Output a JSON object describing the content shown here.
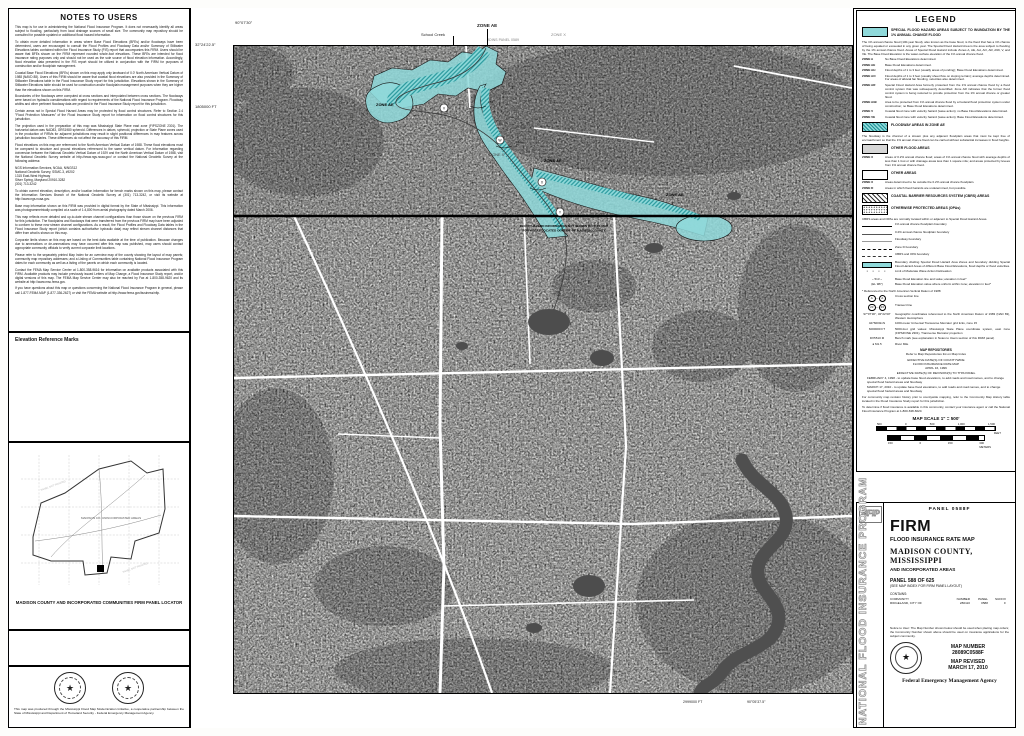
{
  "notes": {
    "title": "NOTES TO USERS",
    "erm_title": "Elevation Reference Marks",
    "paragraphs": [
      "This map is for use in administering the National Flood Insurance Program. It does not necessarily identify all areas subject to flooding, particularly from local drainage sources of small size. The community map repository should be consulted for possible updated or additional flood hazard information.",
      "To obtain more detailed information in areas where Base Flood Elevations (BFEs) and/or floodways have been determined, users are encouraged to consult the Flood Profiles and Floodway Data and/or Summary of Stillwater Elevations tables contained within the Flood Insurance Study (FIS) report that accompanies this FIRM. Users should be aware that BFEs shown on the FIRM represent rounded whole-foot elevations. These BFEs are intended for flood insurance rating purposes only and should not be used as the sole source of flood elevation information. Accordingly, flood elevation data presented in the FIS report should be utilized in conjunction with the FIRM for purposes of construction and/or floodplain management.",
      "Coastal Base Flood Elevations (BFEs) shown on this map apply only landward of 0.0' North American Vertical Datum of 1988 (NAVD 88). Users of this FIRM should be aware that coastal flood elevations are also provided in the Summary of Stillwater Elevations table in the Flood Insurance Study report for this jurisdiction. Elevations shown in the Summary of Stillwater Elevations table should be used for construction and/or floodplain management purposes when they are higher than the elevations shown on this FIRM.",
      "Boundaries of the floodways were computed at cross sections and interpolated between cross sections. The floodways were based on hydraulic considerations with regard to requirements of the National Flood Insurance Program. Floodway widths and other pertinent floodway data are provided in the Flood Insurance Study report for this jurisdiction.",
      "Certain areas not in Special Flood Hazard Areas may be protected by flood control structures. Refer to Section 2.4 \"Flood Protection Measures\" of the Flood Insurance Study report for information on flood control structures for this jurisdiction.",
      "The projection used in the preparation of this map was Mississippi State Plane east zone (FIPSZONE 2301). The horizontal datum was NAD83, GRS1980 spheroid. Differences in datum, spheroid, projection or State Plane zones used in the production of FIRMs for adjacent jurisdictions may result in slight positional differences in map features across jurisdiction boundaries. These differences do not affect the accuracy of this FIRM.",
      "Flood elevations on this map are referenced to the North American Vertical Datum of 1988. These flood elevations must be compared to structure and ground elevations referenced to the same vertical datum. For information regarding conversion between the National Geodetic Vertical Datum of 1929 and the North American Vertical Datum of 1988, visit the National Geodetic Survey website at http://www.ngs.noaa.gov/ or contact the National Geodetic Survey at the following address:",
      "NGS Information Services, NOAA, N/NGS12\nNational Geodetic Survey, SSMC-3, #9202\n1315 East-West Highway\nSilver Spring, Maryland 20910-3282\n(301) 713-3242",
      "To obtain current elevation, description, and/or location information for bench marks shown on this map, please contact the Information Services Branch of the National Geodetic Survey at (301) 713-3242, or visit its website at http://www.ngs.noaa.gov.",
      "Base map information shown on this FIRM was provided in digital format by the State of Mississippi. This information was photogrammetrically compiled at a scale of 1:4,800 from aerial photography dated March 2006.",
      "This map reflects more detailed and up-to-date stream channel configurations than those shown on the previous FIRM for this jurisdiction. The floodplains and floodways that were transferred from the previous FIRM may have been adjusted to conform to these new stream channel configurations. As a result, the Flood Profiles and Floodway Data tables in the Flood Insurance Study report (which contains authoritative hydraulic data) may reflect stream channel distances that differ from what is shown on this map.",
      "Corporate limits shown on this map are based on the best data available at the time of publication. Because changes due to annexations or de-annexations may have occurred after this map was published, map users should contact appropriate community officials to verify current corporate limit locations.",
      "Please refer to the separately printed Map Index for an overview map of the county showing the layout of map panels; community map repository addresses; and a Listing of Communities table containing National Flood Insurance Program dates for each community as well as a listing of the panels on which each community is located.",
      "Contact the FEMA Map Service Center at 1-800-358-9616 for information on available products associated with this FIRM. Available products may include previously issued Letters of Map Change, a Flood Insurance Study report, and/or digital versions of this map. The FEMA Map Service Center may also be reached by Fax at 1-800-358-9620 and its website at http://www.msc.fema.gov.",
      "If you have questions about this map or questions concerning the National Flood Insurance Program in general, please call 1-877-FEMA MAP (1-877-336-2627) or visit the FEMA website at http://www.fema.gov/business/nfip."
    ]
  },
  "locator": {
    "label": "MADISON COUNTY AND INCORPORATED COMMUNITIES FIRM PANEL LOCATOR",
    "panel_not_printed": "PANEL NOT PRINTED",
    "inner_label": "MADISON CO. UNINCORPORATED AREAS",
    "credit": "This map was produced through the Mississippi Flood Map Modernization Initiative, a cooperative partnership between the State of Mississippi and Department of Homeland Security - Federal Emergency Management Agency."
  },
  "map": {
    "collar": {
      "top_left_lon": "90°07'30\"",
      "top_left_lat": "32°24'22.5\"",
      "bottom_grid": "2999000 FT",
      "bottom_lon": "90°05'37.5\"",
      "left_grid": "1805000 FT"
    },
    "joins_top": "JOINS PANEL 0589",
    "joins_right": "JOINS PANEL 0590",
    "labels": {
      "school_creek": "School Creek",
      "zone_ae": "ZONE AE",
      "zone_x": "ZONE X",
      "bfe_282": "282",
      "bfe_286": "286",
      "county_note_1": "FLOOD HAZARD INFORMATION NOT SHOWN ON THIS MAP",
      "county_note_2": "FOR AREAS LOCATED OUTSIDE OF MADISON COUNTY",
      "xs_v": "V",
      "xs_w": "W",
      "xs_x": "X",
      "xs_y": "Y"
    },
    "annotations": {
      "pct_note_1": "0.2% FLOODING EFFECTS FROM",
      "pct_note_2": "BRASHEAR CREEK",
      "grid_1803": "1803000 FT",
      "zone_x": "ZONE X",
      "flooding_note_1": "FLOODING EFFECTS FROM",
      "flooding_note_2": "BRASHEAR CREEK"
    }
  },
  "legend": {
    "title": "LEGEND",
    "sfha_header": "SPECIAL FLOOD HAZARD AREAS SUBJECT TO INUNDATION BY THE 1% ANNUAL CHANCE FLOOD",
    "sfha_intro": "The 1% annual chance flood (100-year flood), also known as the base flood, is the flood that has a 1% chance of being equaled or exceeded in any given year. The Special Flood Hazard Area is the area subject to flooding by the 1% annual chance flood. Areas of Special Flood Hazard include Zones A, AE, AH, AO, AR, A99, V, and VE. The Base Flood Elevation is the water-surface elevation of the 1% annual chance flood.",
    "sfha_zones": [
      {
        "name": "ZONE A",
        "desc": "No Base Flood Elevations determined."
      },
      {
        "name": "ZONE AE",
        "desc": "Base Flood Elevations determined."
      },
      {
        "name": "ZONE AH",
        "desc": "Flood depths of 1 to 3 feet (usually areas of ponding); Base Flood Elevations determined."
      },
      {
        "name": "ZONE AO",
        "desc": "Flood depths of 1 to 3 feet (usually sheet flow on sloping terrain); average depths determined. For areas of alluvial fan flooding, velocities also determined."
      },
      {
        "name": "ZONE AR",
        "desc": "Special Flood Hazard Area formerly protected from the 1% annual chance flood by a flood control system that was subsequently decertified. Zone AR indicates that the former flood control system is being restored to provide protection from the 1% annual chance or greater flood."
      },
      {
        "name": "ZONE A99",
        "desc": "Area to be protected from 1% annual chance flood by a Federal flood protection system under construction; no Base Flood Elevations determined."
      },
      {
        "name": "ZONE V",
        "desc": "Coastal flood zone with velocity hazard (wave action); no Base Flood Elevations determined."
      },
      {
        "name": "ZONE VE",
        "desc": "Coastal flood zone with velocity hazard (wave action); Base Flood Elevations determined."
      }
    ],
    "floodway_header": "FLOODWAY AREAS IN ZONE AE",
    "floodway_note": "The floodway is the channel of a stream plus any adjacent floodplain areas that must be kept free of encroachment so that the 1% annual chance flood can be carried without substantial increases in flood heights.",
    "other_flood_header": "OTHER FLOOD AREAS",
    "zone_x_shaded": {
      "name": "ZONE X",
      "desc": "Areas of 0.2% annual chance flood; areas of 1% annual chance flood with average depths of less than 1 foot or with drainage areas less than 1 square mile; and areas protected by levees from 1% annual chance flood."
    },
    "other_areas_header": "OTHER AREAS",
    "zone_x": {
      "name": "ZONE X",
      "desc": "Areas determined to be outside the 0.2% annual chance floodplain."
    },
    "zone_d": {
      "name": "ZONE D",
      "desc": "Areas in which flood hazards are undetermined, but possible."
    },
    "cbrs_header": "COASTAL BARRIER RESOURCES SYSTEM (CBRS) AREAS",
    "opa_header": "OTHERWISE PROTECTED AREAS (OPAs)",
    "cbrs_note": "CBRS areas and OPAs are normally located within or adjacent to Special Flood Hazard Areas.",
    "lines": [
      "1% annual chance floodplain boundary",
      "0.2% annual chance floodplain boundary",
      "Floodway boundary",
      "Zone D boundary",
      "CBRS and OPA boundary",
      "Boundary dividing Special Flood Hazard Area Zones and boundary dividing Special Flood Hazard Areas of different Base Flood Elevations, flood depths or flood velocities.",
      "Limit of Moderate Wave Action Delineation"
    ],
    "bfe_line": {
      "symbol": "~ 513 ~",
      "desc": "Base Flood Elevation line and value; elevation in feet*"
    },
    "bfe_zone": {
      "symbol": "(EL 987)",
      "desc": "Base Flood Elevation value where uniform within zone; elevation in feet*"
    },
    "navd_note": "* Referenced to the North American Vertical Datum of 1988",
    "cross_section": {
      "letter": "A",
      "desc": "Cross section line"
    },
    "transect": {
      "number": "23",
      "desc": "Transect line"
    },
    "geo": {
      "symbol": "97°07'30\", 32°22'30\"",
      "desc": "Geographic coordinates referenced to the North American Datum of 1983 (NAD 83), Western Hemisphere"
    },
    "utm": {
      "symbol": "4276000mN",
      "desc": "1000-meter Universal Transverse Mercator grid ticks, zone 15"
    },
    "spc": {
      "symbol": "6000000 FT",
      "desc": "5000-foot grid values: Mississippi State Plane coordinate system, east zone (FIPSZONE 2301), Transverse Mercator projection"
    },
    "benchmark": {
      "symbol": "DX5510 ⊗",
      "desc": "Bench mark (see explanation in Notes to Users section of this FIRM panel)"
    },
    "river_mile": {
      "symbol": "● M1.5",
      "desc": "River Mile"
    },
    "repositories": {
      "title": "MAP REPOSITORIES",
      "desc": "Refer to Map Repositories list on Map Index"
    },
    "effective": {
      "line1": "EFFECTIVE DATE(S) OF COUNTYWIDE",
      "line2": "FLOOD INSURANCE RATE MAP",
      "date": "APRIL 16, 1996",
      "rev_header": "EFFECTIVE DATE(S) OF REVISION(S) TO THIS PANEL",
      "rev1": "FEBRUARY 4, 1998 - to update base flood elevations, to add roads and road names, and to change special flood hazard areas and floodway",
      "rev2": "MARCH 17, 2010 - to update base flood elevations, to add roads and road names, and to change special flood hazard areas and floodway"
    },
    "history_note": "For community map revision history prior to countywide mapping, refer to the Community Map History table located in the Flood Insurance Study report for this jurisdiction.",
    "insurance_note": "To determine if flood insurance is available in this community, contact your insurance agent or call the National Flood Insurance Program at 1-800-638-6620.",
    "scale": {
      "title": "MAP SCALE 1\" = 500'",
      "feet_ticks": [
        "500",
        "0",
        "500",
        "1,000",
        "1,500"
      ],
      "feet_label": "FEET",
      "meters_ticks": [
        "150",
        "0",
        "150",
        "300"
      ],
      "meters_label": "METERS"
    }
  },
  "titleblock": {
    "nfip_logo": "NFIP",
    "nfip_vertical": "NATIONAL FLOOD INSURANCE PROGRAM",
    "panel_header": "PANEL 0588F",
    "firm": "FIRM",
    "subtitle": "FLOOD INSURANCE RATE MAP",
    "county": "MADISON COUNTY,",
    "state": "MISSISSIPPI",
    "incorporated": "AND INCORPORATED AREAS",
    "panel_line": "PANEL 588 OF 625",
    "see_index": "(SEE MAP INDEX FOR FIRM PANEL LAYOUT)",
    "contains": "CONTAINS:",
    "columns": [
      "COMMUNITY",
      "NUMBER",
      "PANEL",
      "SUFFIX"
    ],
    "community_row": [
      "RIDGELAND, CITY OF",
      "280110",
      "0588",
      "F"
    ],
    "notice": "Notice to User: The Map Number shown below should be used when placing map orders; the Community Number shown above should be used on insurance applications for the subject community.",
    "map_number_label": "MAP NUMBER",
    "map_number": "28089C0588F",
    "revised_label": "MAP REVISED",
    "revised_date": "MARCH 17, 2010",
    "agency": "Federal Emergency Management Agency"
  },
  "colors": {
    "flood_zone_cyan": "#8fd9da",
    "floodway_teal": "#1f9296",
    "water_dark": "#4d4d4d",
    "shaded_x_grey": "#d6d6d6"
  }
}
